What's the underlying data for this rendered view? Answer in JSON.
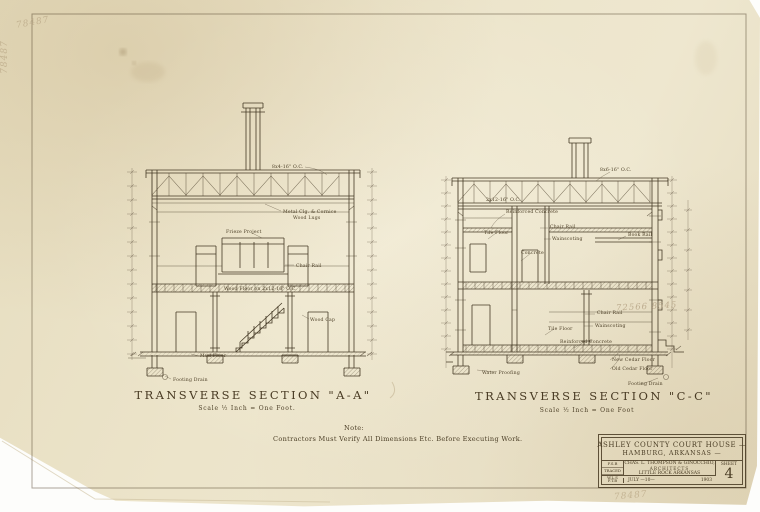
{
  "note": {
    "label": "Note:",
    "text": "Contractors Must Verify All Dimensions Etc. Before Executing Work."
  },
  "secA": {
    "title": "Transverse Section \"A-A\"",
    "scale": "Scale ½ Inch = One Foot.",
    "labels": {
      "joists": "8x4-16\" O.C.",
      "ceiling1": "Metal Clg. & Cornice",
      "ceiling2": "Wood Lugs",
      "frieze": "Frieze Project",
      "chair_rail": "Chair Rail",
      "floor": "Wood Floor on 2x12-16\" O.C.",
      "wood_cap": "Wood Cap",
      "mud_floor": "Mud Floor",
      "footing_drain": "Footing Drain"
    }
  },
  "secC": {
    "title": "Transverse Section \"C-C\"",
    "scale": "Scale ½ Inch = One Foot",
    "labels": {
      "joists": "8x6-16\" O.C.",
      "joists2": "2x12-16\" O.C.",
      "reinf_concrete_up": "Reinforced Concrete",
      "chair_rail_up": "Chair Rail",
      "tile_floor_up": "Tile Floor",
      "wainscot_up": "Wainscoting",
      "concrete": "Concrete",
      "book_rail": "Book Rail",
      "chair_rail_low": "Chair Rail",
      "wainscot_low": "Wainscoting",
      "tile_floor_low": "Tile Floor",
      "reinf_concrete_low": "Reinforced Concrete",
      "new_cedar": "New Cedar Floor",
      "old_cedar": "Old Cedar Floor",
      "water_proofing": "Water Proofing",
      "footing_drain": "Footing Drain"
    },
    "pencil_calc": "72566  8545"
  },
  "title_block": {
    "project": "Ashley County Court House —",
    "location": "Hamburg, Arkansas —",
    "credits": {
      "c1": "F.S.B",
      "c2": "Traced",
      "c3": "W.L.S"
    },
    "firm_line1": "Chas. L. Thompson & Ginocchio,",
    "firm_line2": "Architects",
    "firm_line3": "Little Rock Arkansas",
    "sheet_label": "Sheet",
    "sheet_number": "4",
    "drawn_by": "F.T.B",
    "date": "July —10—",
    "year": "1903"
  },
  "pencil": {
    "top_left": "78487",
    "left_edge": "78487",
    "bottom_right": "78487"
  }
}
